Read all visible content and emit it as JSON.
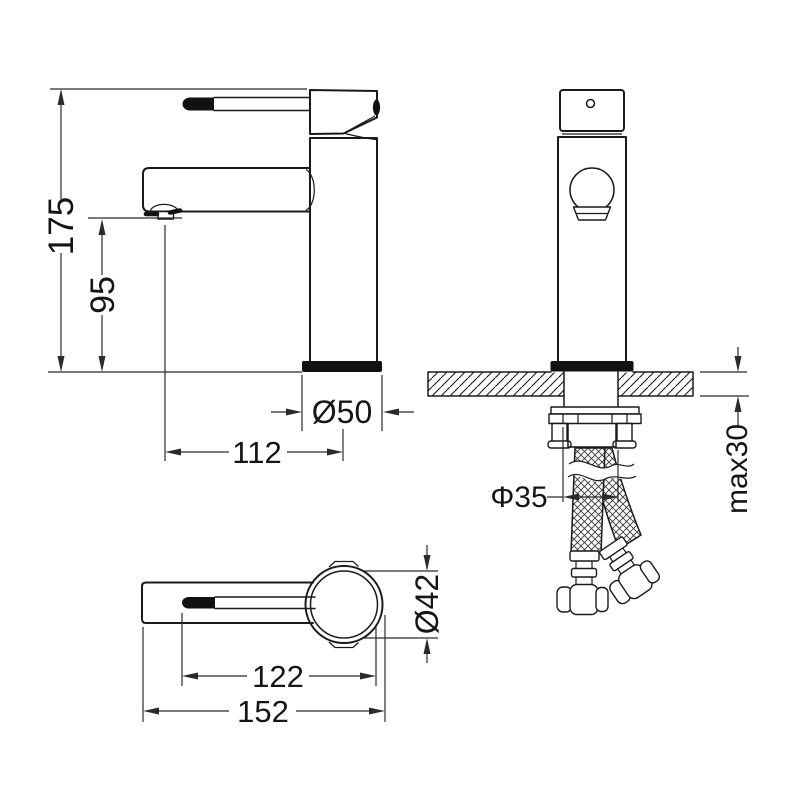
{
  "drawing_type": "faucet installation technical drawing",
  "colors": {
    "background": "#ffffff",
    "line": "#1a1a1a",
    "dimension_line": "#2b2b2b",
    "solid_fill": "#111111"
  },
  "dimensions": {
    "side": {
      "overall_height": "175",
      "spout_height": "95",
      "base_diameter": "Ø50",
      "spout_reach": "112"
    },
    "front": {
      "shank_diameter": "Φ35",
      "max_counter_thickness": "max30"
    },
    "top": {
      "body_diameter": "Ø42",
      "handle_span": "122",
      "overall_length": "152"
    }
  }
}
